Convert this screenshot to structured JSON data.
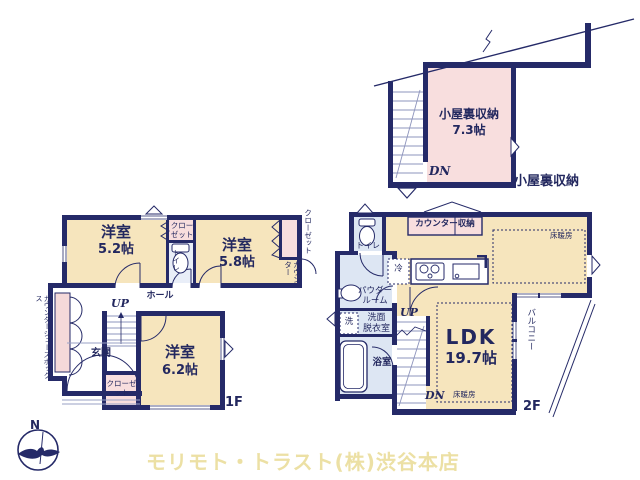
{
  "attic": {
    "name": "小屋裏収納",
    "size": "7.3帖",
    "dn": "DN",
    "outside_label": "小屋裏収納"
  },
  "f1": {
    "room1": {
      "name": "洋室",
      "size": "5.2帖"
    },
    "room2": {
      "name": "洋室",
      "size": "5.8帖"
    },
    "room3": {
      "name": "洋室",
      "size": "6.2帖"
    },
    "closet_top": "クローゼット",
    "closet_right": "クローゼット",
    "closet_bottom": "クローゼット",
    "toilet": "トイレ",
    "counter": "カウンター",
    "hall": "ホール",
    "entrance": "玄関",
    "shoebox": "カウンターシューズボックス",
    "up": "UP",
    "floor_label": "1F"
  },
  "f2": {
    "toilet": "トイレ",
    "counter_storage": "カウンター収納",
    "floor_heating_top": "床暖房",
    "floor_heating_bottom": "床暖房",
    "fridge": "冷",
    "powder_line1": "パウダー",
    "powder_line2": "ルーム",
    "wash": "洗",
    "washroom_line1": "洗面",
    "washroom_line2": "脱衣室",
    "bath": "浴室",
    "ldk": {
      "name": "LDK",
      "size": "19.7帖"
    },
    "balcony": "バルコニー",
    "up": "UP",
    "dn": "DN",
    "floor_label": "2F"
  },
  "footer": {
    "company": "モリモト・トラスト(株)渋谷本店",
    "north": "N"
  },
  "colors": {
    "wall_navy": "#252a68",
    "room_cream": "#f6e5bd",
    "closet_pink": "#f8dede",
    "wet_blue": "#dde6f3",
    "footer_yellow": "#ece0a4"
  }
}
